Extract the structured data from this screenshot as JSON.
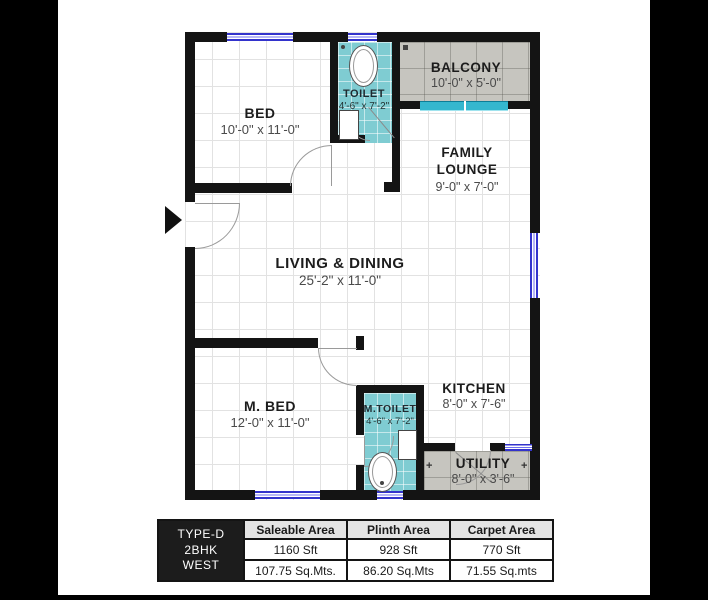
{
  "plan": {
    "rooms": [
      {
        "name": "BED",
        "dims": "10'-0\" x 11'-0\""
      },
      {
        "name": "TOILET",
        "dims": "4'-6\" x 7'-2\""
      },
      {
        "name": "BALCONY",
        "dims": "10'-0\" x 5'-0\""
      },
      {
        "name": "FAMILY LOUNGE",
        "dims": "9'-0\" x 7'-0\""
      },
      {
        "name": "LIVING & DINING",
        "dims": "25'-2\" x 11'-0\""
      },
      {
        "name": "M. BED",
        "dims": "12'-0\" x 11'-0\""
      },
      {
        "name": "M.TOILET",
        "dims": "4'-6\" x 7'-2\""
      },
      {
        "name": "KITCHEN",
        "dims": "8'-0\" x 7'-6\""
      },
      {
        "name": "UTILITY",
        "dims": "8'-0\" x 3'-6\""
      }
    ],
    "colors": {
      "wall": "#141414",
      "toilet_tile": "#7fccd2",
      "paved_tile": "#c6c5bf",
      "window_blue": "#3333cc",
      "sliding_cyan": "#35b7ce"
    },
    "plus_mark": "+"
  },
  "area_table": {
    "unit_lines": [
      "TYPE-D",
      "2BHK",
      "WEST"
    ],
    "columns": [
      {
        "header": "Saleable Area",
        "sft": "1160 Sft",
        "sqm": "107.75 Sq.Mts."
      },
      {
        "header": "Plinth Area",
        "sft": "928 Sft",
        "sqm": "86.20 Sq.Mts"
      },
      {
        "header": "Carpet Area",
        "sft": "770 Sft",
        "sqm": "71.55 Sq.mts"
      }
    ]
  }
}
